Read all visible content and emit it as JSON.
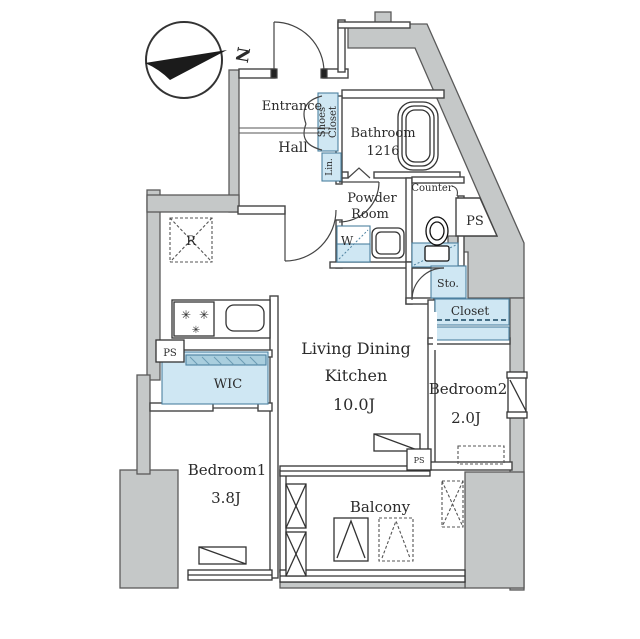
{
  "compass": {
    "north_label": "N"
  },
  "rooms": {
    "entrance": {
      "label": "Entrance"
    },
    "hall": {
      "label": "Hall"
    },
    "shoes_closet": {
      "line1": "Shoes",
      "line2": "Closet"
    },
    "linen": {
      "label": "Lin."
    },
    "bathroom": {
      "label": "Bathroom",
      "size": "1216"
    },
    "powder_room": {
      "line1": "Powder",
      "line2": "Room"
    },
    "counter": {
      "label": "Counter"
    },
    "washer": {
      "label": "W"
    },
    "storage": {
      "label": "Sto."
    },
    "closet": {
      "label": "Closet"
    },
    "ldk": {
      "line1": "Living Dining",
      "line2": "Kitchen",
      "size": "10.0J"
    },
    "bedroom2": {
      "label": "Bedroom2",
      "size": "2.0J"
    },
    "wic": {
      "label": "WIC"
    },
    "bedroom1": {
      "label": "Bedroom1",
      "size": "3.8J"
    },
    "balcony": {
      "label": "Balcony"
    },
    "refrigerator": {
      "label": "R"
    }
  },
  "pipe_spaces": {
    "ps_top": "PS",
    "ps_left": "PS",
    "ps_small": "PS"
  },
  "icons": {
    "burner": "✳"
  },
  "colors": {
    "wall_gray": "#c5c8c8",
    "fixture_blue": "#cfe7f3",
    "line": "#444444"
  }
}
